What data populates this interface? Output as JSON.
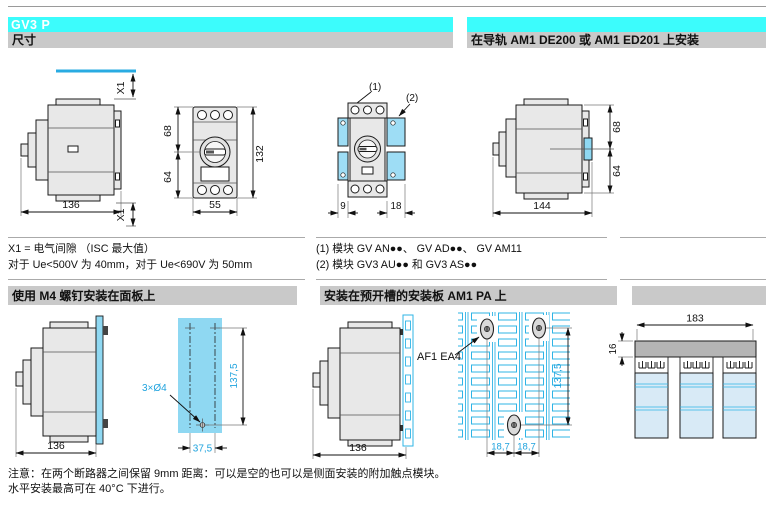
{
  "page": {
    "product_title": "GV3 P",
    "colors": {
      "header_cyan": "#3CFCFC",
      "bar_gray": "#C9C9C9",
      "panel_blue": "#8FD8F2",
      "module_blue": "#9EDDF5",
      "dim_blue": "#1FA3DE",
      "grid_cyan": "#2FB4E6",
      "breaker_blue": "#D8EAF6",
      "busbar_gray": "#B5B5B5"
    }
  },
  "sections": {
    "dimensions_title": "尺寸",
    "rail_title": "在导轨 AM1 DE200 或 AM1 ED201 上安装",
    "panel_title": "使用 M4 螺钉安装在面板上",
    "plate_title": "安装在预开槽的安装板 AM1 PA 上"
  },
  "notes": {
    "x1_def": "X1 = 电气间隙 （ISC 最大值）",
    "x1_values": "对于 Ue<500V 为 40mm，对于 Ue<690V 为 50mm",
    "module1": "(1) 模块 GV AN●●、 GV AD●●、 GV AM11",
    "module2": "(2) 模块 GV3 AU●● 和 GV3 AS●●",
    "caution1": "注意：在两个断路器之间保留 9mm 距离：可以是空的也可以是侧面安装的附加触点模块。",
    "caution2": "水平安装最高可在 40°C 下进行。"
  },
  "drawings": {
    "side_view": {
      "width": "136",
      "clearance_top": "X1",
      "clearance_bottom": "X1"
    },
    "front_view": {
      "upper": "68",
      "lower": "64",
      "height": "132",
      "width": "55"
    },
    "module_view": {
      "callout1": "(1)",
      "callout2": "(2)",
      "module1_width": "9",
      "module2_width": "18"
    },
    "rail_view": {
      "width": "144",
      "upper": "68",
      "lower": "64"
    },
    "panel_view": {
      "width": "136",
      "holes": "3×Ø4",
      "vertical": "137,5",
      "horizontal": "37,5"
    },
    "plate_view": {
      "width": "136",
      "clip_ref": "AF1 EA4",
      "vertical": "137,5",
      "pitch1": "18,7",
      "pitch2": "18,7"
    },
    "busbar_view": {
      "width": "183",
      "comb_height": "16"
    }
  }
}
